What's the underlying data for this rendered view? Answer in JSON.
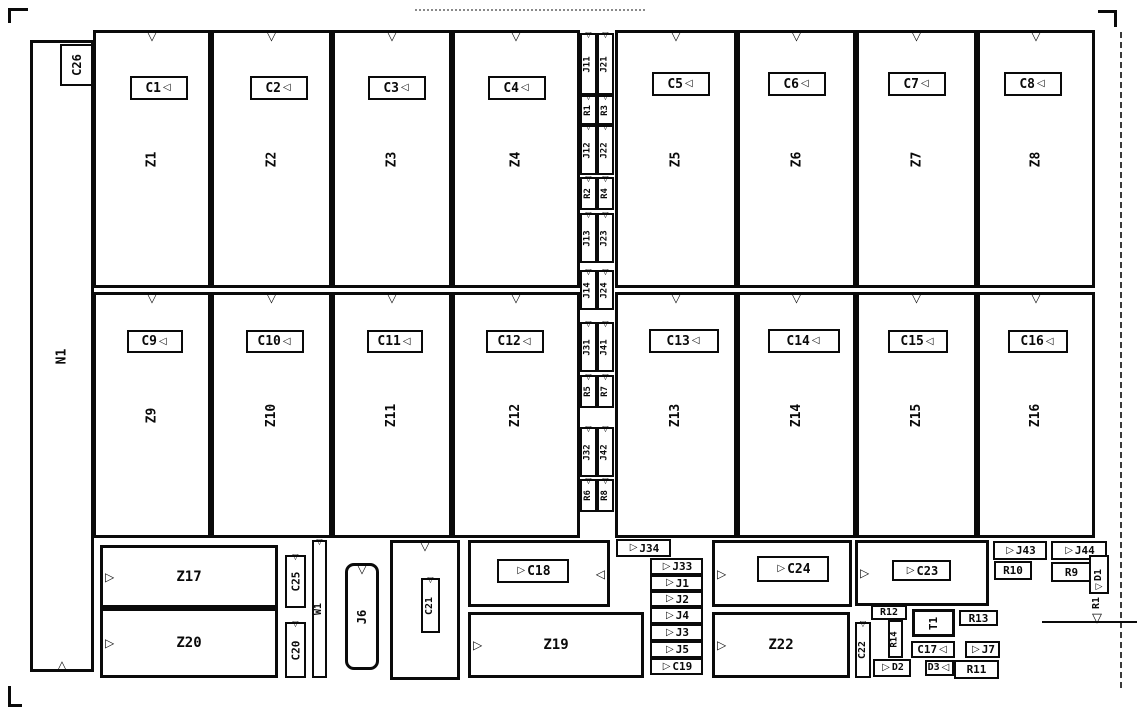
{
  "meta": {
    "width": 1137,
    "height": 720,
    "bg": "#ffffff",
    "ink": "#0a0a0a"
  },
  "icons": {
    "pin1_notch": "▽",
    "pin_up": "△",
    "arrow_right": "▷",
    "arrow_left": "◁"
  },
  "components": [
    {
      "n": "component-n1",
      "t": "N1",
      "x": 30,
      "y": 40,
      "w": 64,
      "h": 632,
      "v": 1,
      "b": 3,
      "tri": [
        "nb"
      ],
      "fs": 13
    },
    {
      "n": "capacitor-c26",
      "t": "C26",
      "x": 60,
      "y": 44,
      "w": 33,
      "h": 42,
      "v": 1,
      "b": 2,
      "tri": [],
      "fs": 12
    },
    {
      "n": "ic-z1",
      "t": "Z1",
      "x": 93,
      "y": 30,
      "w": 118,
      "h": 258,
      "v": 1,
      "b": 3,
      "tri": [
        "nt"
      ],
      "fs": 13
    },
    {
      "n": "ic-z2",
      "t": "Z2",
      "x": 211,
      "y": 30,
      "w": 121,
      "h": 258,
      "v": 1,
      "b": 3,
      "tri": [
        "nt"
      ],
      "fs": 13
    },
    {
      "n": "ic-z3",
      "t": "Z3",
      "x": 332,
      "y": 30,
      "w": 120,
      "h": 258,
      "v": 1,
      "b": 3,
      "tri": [
        "nt"
      ],
      "fs": 13
    },
    {
      "n": "ic-z4",
      "t": "Z4",
      "x": 452,
      "y": 30,
      "w": 128,
      "h": 258,
      "v": 1,
      "b": 3,
      "tri": [
        "nt"
      ],
      "fs": 13
    },
    {
      "n": "ic-z5",
      "t": "Z5",
      "x": 615,
      "y": 30,
      "w": 122,
      "h": 258,
      "v": 1,
      "b": 3,
      "tri": [
        "nt"
      ],
      "fs": 13
    },
    {
      "n": "ic-z6",
      "t": "Z6",
      "x": 737,
      "y": 30,
      "w": 119,
      "h": 258,
      "v": 1,
      "b": 3,
      "tri": [
        "nt"
      ],
      "fs": 13
    },
    {
      "n": "ic-z7",
      "t": "Z7",
      "x": 856,
      "y": 30,
      "w": 121,
      "h": 258,
      "v": 1,
      "b": 3,
      "tri": [
        "nt"
      ],
      "fs": 13
    },
    {
      "n": "ic-z8",
      "t": "Z8",
      "x": 977,
      "y": 30,
      "w": 118,
      "h": 258,
      "v": 1,
      "b": 3,
      "tri": [
        "nt"
      ],
      "fs": 13
    },
    {
      "n": "capacitor-c1",
      "t": "C1",
      "x": 130,
      "y": 76,
      "w": 58,
      "h": 24,
      "v": 0,
      "b": 2,
      "tri": [
        "inR"
      ],
      "fs": 13
    },
    {
      "n": "capacitor-c2",
      "t": "C2",
      "x": 250,
      "y": 76,
      "w": 58,
      "h": 24,
      "v": 0,
      "b": 2,
      "tri": [
        "inR"
      ],
      "fs": 13
    },
    {
      "n": "capacitor-c3",
      "t": "C3",
      "x": 368,
      "y": 76,
      "w": 58,
      "h": 24,
      "v": 0,
      "b": 2,
      "tri": [
        "inR"
      ],
      "fs": 13
    },
    {
      "n": "capacitor-c4",
      "t": "C4",
      "x": 488,
      "y": 76,
      "w": 58,
      "h": 24,
      "v": 0,
      "b": 2,
      "tri": [
        "inR"
      ],
      "fs": 13
    },
    {
      "n": "capacitor-c5",
      "t": "C5",
      "x": 652,
      "y": 72,
      "w": 58,
      "h": 24,
      "v": 0,
      "b": 2,
      "tri": [
        "inR"
      ],
      "fs": 13
    },
    {
      "n": "capacitor-c6",
      "t": "C6",
      "x": 768,
      "y": 72,
      "w": 58,
      "h": 24,
      "v": 0,
      "b": 2,
      "tri": [
        "inR"
      ],
      "fs": 13
    },
    {
      "n": "capacitor-c7",
      "t": "C7",
      "x": 888,
      "y": 72,
      "w": 58,
      "h": 24,
      "v": 0,
      "b": 2,
      "tri": [
        "inR"
      ],
      "fs": 13
    },
    {
      "n": "capacitor-c8",
      "t": "C8",
      "x": 1004,
      "y": 72,
      "w": 58,
      "h": 24,
      "v": 0,
      "b": 2,
      "tri": [
        "inR"
      ],
      "fs": 13
    },
    {
      "n": "ic-z9",
      "t": "Z9",
      "x": 93,
      "y": 292,
      "w": 118,
      "h": 246,
      "v": 1,
      "b": 3,
      "tri": [
        "nt"
      ],
      "fs": 13
    },
    {
      "n": "ic-z10",
      "t": "Z10",
      "x": 211,
      "y": 292,
      "w": 121,
      "h": 246,
      "v": 1,
      "b": 3,
      "tri": [
        "nt"
      ],
      "fs": 13
    },
    {
      "n": "ic-z11",
      "t": "Z11",
      "x": 332,
      "y": 292,
      "w": 120,
      "h": 246,
      "v": 1,
      "b": 3,
      "tri": [
        "nt"
      ],
      "fs": 13
    },
    {
      "n": "ic-z12",
      "t": "Z12",
      "x": 452,
      "y": 292,
      "w": 128,
      "h": 246,
      "v": 1,
      "b": 3,
      "tri": [
        "nt"
      ],
      "fs": 13
    },
    {
      "n": "ic-z13",
      "t": "Z13",
      "x": 615,
      "y": 292,
      "w": 122,
      "h": 246,
      "v": 1,
      "b": 3,
      "tri": [
        "nt"
      ],
      "fs": 13
    },
    {
      "n": "ic-z14",
      "t": "Z14",
      "x": 737,
      "y": 292,
      "w": 119,
      "h": 246,
      "v": 1,
      "b": 3,
      "tri": [
        "nt"
      ],
      "fs": 13
    },
    {
      "n": "ic-z15",
      "t": "Z15",
      "x": 856,
      "y": 292,
      "w": 121,
      "h": 246,
      "v": 1,
      "b": 3,
      "tri": [
        "nt"
      ],
      "fs": 13
    },
    {
      "n": "ic-z16",
      "t": "Z16",
      "x": 977,
      "y": 292,
      "w": 118,
      "h": 246,
      "v": 1,
      "b": 3,
      "tri": [
        "nt"
      ],
      "fs": 13
    },
    {
      "n": "capacitor-c9",
      "t": "C9",
      "x": 127,
      "y": 330,
      "w": 56,
      "h": 23,
      "v": 0,
      "b": 2,
      "tri": [
        "inR"
      ],
      "fs": 13
    },
    {
      "n": "capacitor-c10",
      "t": "C10",
      "x": 246,
      "y": 330,
      "w": 58,
      "h": 23,
      "v": 0,
      "b": 2,
      "tri": [
        "inR"
      ],
      "fs": 13
    },
    {
      "n": "capacitor-c11",
      "t": "C11",
      "x": 367,
      "y": 330,
      "w": 56,
      "h": 23,
      "v": 0,
      "b": 2,
      "tri": [
        "inR"
      ],
      "fs": 13
    },
    {
      "n": "capacitor-c12",
      "t": "C12",
      "x": 486,
      "y": 330,
      "w": 58,
      "h": 23,
      "v": 0,
      "b": 2,
      "tri": [
        "inR"
      ],
      "fs": 13
    },
    {
      "n": "capacitor-c13",
      "t": "C13",
      "x": 649,
      "y": 329,
      "w": 70,
      "h": 24,
      "v": 0,
      "b": 2,
      "tri": [
        "inR"
      ],
      "fs": 13
    },
    {
      "n": "capacitor-c14",
      "t": "C14",
      "x": 768,
      "y": 329,
      "w": 72,
      "h": 24,
      "v": 0,
      "b": 2,
      "tri": [
        "inR"
      ],
      "fs": 13
    },
    {
      "n": "capacitor-c15",
      "t": "C15",
      "x": 888,
      "y": 330,
      "w": 60,
      "h": 23,
      "v": 0,
      "b": 2,
      "tri": [
        "inR"
      ],
      "fs": 13
    },
    {
      "n": "capacitor-c16",
      "t": "C16",
      "x": 1008,
      "y": 330,
      "w": 60,
      "h": 23,
      "v": 0,
      "b": 2,
      "tri": [
        "inR"
      ],
      "fs": 13
    },
    {
      "n": "jumper-j11",
      "t": "J11",
      "x": 580,
      "y": 33,
      "w": 17,
      "h": 62,
      "v": 1,
      "b": 2,
      "tri": [
        "nt"
      ],
      "fs": 9
    },
    {
      "n": "resistor-r1",
      "t": "R1",
      "x": 580,
      "y": 95,
      "w": 17,
      "h": 30,
      "v": 1,
      "b": 2,
      "tri": [
        "nt"
      ],
      "fs": 9
    },
    {
      "n": "jumper-j12",
      "t": "J12",
      "x": 580,
      "y": 125,
      "w": 17,
      "h": 50,
      "v": 1,
      "b": 2,
      "tri": [
        "nt"
      ],
      "fs": 9
    },
    {
      "n": "resistor-r2",
      "t": "R2",
      "x": 580,
      "y": 177,
      "w": 17,
      "h": 33,
      "v": 1,
      "b": 2,
      "tri": [
        "nt"
      ],
      "fs": 9
    },
    {
      "n": "jumper-j13",
      "t": "J13",
      "x": 580,
      "y": 213,
      "w": 17,
      "h": 50,
      "v": 1,
      "b": 2,
      "tri": [
        "nt"
      ],
      "fs": 9
    },
    {
      "n": "jumper-j14",
      "t": "J14",
      "x": 580,
      "y": 270,
      "w": 17,
      "h": 40,
      "v": 1,
      "b": 2,
      "tri": [
        "nt"
      ],
      "fs": 9
    },
    {
      "n": "jumper-j31",
      "t": "J31",
      "x": 580,
      "y": 322,
      "w": 17,
      "h": 50,
      "v": 1,
      "b": 2,
      "tri": [
        "nt"
      ],
      "fs": 9
    },
    {
      "n": "resistor-r5",
      "t": "R5",
      "x": 580,
      "y": 375,
      "w": 17,
      "h": 33,
      "v": 1,
      "b": 2,
      "tri": [
        "nt"
      ],
      "fs": 9
    },
    {
      "n": "jumper-j32",
      "t": "J32",
      "x": 580,
      "y": 427,
      "w": 17,
      "h": 50,
      "v": 1,
      "b": 2,
      "tri": [
        "nt"
      ],
      "fs": 9
    },
    {
      "n": "resistor-r6",
      "t": "R6",
      "x": 580,
      "y": 479,
      "w": 17,
      "h": 33,
      "v": 1,
      "b": 2,
      "tri": [
        "nt"
      ],
      "fs": 9
    },
    {
      "n": "jumper-j21",
      "t": "J21",
      "x": 597,
      "y": 33,
      "w": 17,
      "h": 62,
      "v": 1,
      "b": 2,
      "tri": [
        "nt"
      ],
      "fs": 9
    },
    {
      "n": "resistor-r3",
      "t": "R3",
      "x": 597,
      "y": 95,
      "w": 17,
      "h": 30,
      "v": 1,
      "b": 2,
      "tri": [
        "nt"
      ],
      "fs": 9
    },
    {
      "n": "jumper-j22",
      "t": "J22",
      "x": 597,
      "y": 125,
      "w": 17,
      "h": 50,
      "v": 1,
      "b": 2,
      "tri": [
        "nt"
      ],
      "fs": 9
    },
    {
      "n": "resistor-r4",
      "t": "R4",
      "x": 597,
      "y": 177,
      "w": 17,
      "h": 33,
      "v": 1,
      "b": 2,
      "tri": [
        "nt"
      ],
      "fs": 9
    },
    {
      "n": "jumper-j23",
      "t": "J23",
      "x": 597,
      "y": 213,
      "w": 17,
      "h": 50,
      "v": 1,
      "b": 2,
      "tri": [
        "nt"
      ],
      "fs": 9
    },
    {
      "n": "jumper-j24",
      "t": "J24",
      "x": 597,
      "y": 270,
      "w": 17,
      "h": 40,
      "v": 1,
      "b": 2,
      "tri": [
        "nt"
      ],
      "fs": 9
    },
    {
      "n": "jumper-j41",
      "t": "J41",
      "x": 597,
      "y": 322,
      "w": 17,
      "h": 50,
      "v": 1,
      "b": 2,
      "tri": [
        "nt"
      ],
      "fs": 9
    },
    {
      "n": "resistor-r7",
      "t": "R7",
      "x": 597,
      "y": 375,
      "w": 17,
      "h": 33,
      "v": 1,
      "b": 2,
      "tri": [
        "nt"
      ],
      "fs": 9
    },
    {
      "n": "jumper-j42",
      "t": "J42",
      "x": 597,
      "y": 427,
      "w": 17,
      "h": 50,
      "v": 1,
      "b": 2,
      "tri": [
        "nt"
      ],
      "fs": 9
    },
    {
      "n": "resistor-r8",
      "t": "R8",
      "x": 597,
      "y": 479,
      "w": 17,
      "h": 33,
      "v": 1,
      "b": 2,
      "tri": [
        "nt"
      ],
      "fs": 9
    },
    {
      "n": "ic-z17",
      "t": "Z17",
      "x": 100,
      "y": 545,
      "w": 178,
      "h": 63,
      "v": 0,
      "b": 3,
      "tri": [
        "edgeL"
      ],
      "fs": 14
    },
    {
      "n": "ic-z20",
      "t": "Z20",
      "x": 100,
      "y": 608,
      "w": 178,
      "h": 70,
      "v": 0,
      "b": 3,
      "tri": [
        "edgeL"
      ],
      "fs": 14
    },
    {
      "n": "capacitor-c25",
      "t": "C25",
      "x": 285,
      "y": 555,
      "w": 21,
      "h": 53,
      "v": 1,
      "b": 2,
      "tri": [
        "nt"
      ],
      "fs": 11
    },
    {
      "n": "capacitor-c20",
      "t": "C20",
      "x": 285,
      "y": 622,
      "w": 21,
      "h": 56,
      "v": 1,
      "b": 2,
      "tri": [
        "nt"
      ],
      "fs": 11
    },
    {
      "n": "jumper-w1",
      "t": "W1",
      "x": 312,
      "y": 540,
      "w": 15,
      "h": 138,
      "v": 1,
      "b": 2,
      "tri": [
        "nt"
      ],
      "fs": 10
    },
    {
      "n": "connector-j6",
      "t": "J6",
      "x": 345,
      "y": 563,
      "w": 34,
      "h": 107,
      "v": 1,
      "b": 3,
      "tri": [
        "nt"
      ],
      "fs": 12,
      "r": 1
    },
    {
      "n": "container-c21",
      "t": "",
      "x": 390,
      "y": 540,
      "w": 70,
      "h": 140,
      "v": 0,
      "b": 3,
      "tri": [
        "nt"
      ]
    },
    {
      "n": "capacitor-c21",
      "t": "C21",
      "x": 421,
      "y": 578,
      "w": 19,
      "h": 55,
      "v": 1,
      "b": 2,
      "tri": [
        "nt"
      ],
      "fs": 10
    },
    {
      "n": "container-c18",
      "t": "",
      "x": 468,
      "y": 540,
      "w": 142,
      "h": 67,
      "v": 0,
      "b": 3,
      "tri": [
        "edgeR"
      ]
    },
    {
      "n": "capacitor-c18",
      "t": "C18",
      "x": 497,
      "y": 559,
      "w": 72,
      "h": 24,
      "v": 0,
      "b": 2,
      "tri": [
        "inL"
      ],
      "fs": 13
    },
    {
      "n": "ic-z19",
      "t": "Z19",
      "x": 468,
      "y": 612,
      "w": 176,
      "h": 66,
      "v": 0,
      "b": 3,
      "tri": [
        "edgeL"
      ],
      "fs": 14
    },
    {
      "n": "jumper-j34",
      "t": "J34",
      "x": 616,
      "y": 539,
      "w": 55,
      "h": 18,
      "v": 0,
      "b": 2,
      "tri": [
        "inL"
      ],
      "fs": 11
    },
    {
      "n": "jumper-j33",
      "t": "J33",
      "x": 650,
      "y": 558,
      "w": 53,
      "h": 17,
      "v": 0,
      "b": 2,
      "tri": [
        "inL"
      ],
      "fs": 11
    },
    {
      "n": "jumper-j1",
      "t": "J1",
      "x": 650,
      "y": 575,
      "w": 53,
      "h": 16,
      "v": 0,
      "b": 2,
      "tri": [
        "inL"
      ],
      "fs": 11
    },
    {
      "n": "jumper-j2",
      "t": "J2",
      "x": 650,
      "y": 591,
      "w": 53,
      "h": 16,
      "v": 0,
      "b": 2,
      "tri": [
        "inL"
      ],
      "fs": 11
    },
    {
      "n": "jumper-j4",
      "t": "J4",
      "x": 650,
      "y": 607,
      "w": 53,
      "h": 17,
      "v": 0,
      "b": 2,
      "tri": [
        "inL"
      ],
      "fs": 11
    },
    {
      "n": "jumper-j3",
      "t": "J3",
      "x": 650,
      "y": 624,
      "w": 53,
      "h": 17,
      "v": 0,
      "b": 2,
      "tri": [
        "inL"
      ],
      "fs": 11
    },
    {
      "n": "jumper-j5",
      "t": "J5",
      "x": 650,
      "y": 641,
      "w": 53,
      "h": 17,
      "v": 0,
      "b": 2,
      "tri": [
        "inL"
      ],
      "fs": 11
    },
    {
      "n": "capacitor-c19",
      "t": "C19",
      "x": 650,
      "y": 658,
      "w": 53,
      "h": 17,
      "v": 0,
      "b": 2,
      "tri": [
        "inL"
      ],
      "fs": 11
    },
    {
      "n": "container-c24",
      "t": "",
      "x": 712,
      "y": 540,
      "w": 140,
      "h": 67,
      "v": 0,
      "b": 3,
      "tri": [
        "edgeL"
      ]
    },
    {
      "n": "capacitor-c24",
      "t": "C24",
      "x": 757,
      "y": 556,
      "w": 72,
      "h": 26,
      "v": 0,
      "b": 2,
      "tri": [
        "inL"
      ],
      "fs": 13
    },
    {
      "n": "ic-z22",
      "t": "Z22",
      "x": 712,
      "y": 612,
      "w": 138,
      "h": 66,
      "v": 0,
      "b": 3,
      "tri": [
        "edgeL"
      ],
      "fs": 14
    },
    {
      "n": "container-c23",
      "t": "",
      "x": 855,
      "y": 540,
      "w": 134,
      "h": 66,
      "v": 0,
      "b": 3,
      "tri": [
        "edgeL"
      ]
    },
    {
      "n": "capacitor-c23",
      "t": "C23",
      "x": 892,
      "y": 560,
      "w": 59,
      "h": 21,
      "v": 0,
      "b": 2,
      "tri": [
        "inL"
      ],
      "fs": 12
    },
    {
      "n": "jumper-j43",
      "t": "J43",
      "x": 993,
      "y": 541,
      "w": 54,
      "h": 19,
      "v": 0,
      "b": 2,
      "tri": [
        "inL"
      ],
      "fs": 11
    },
    {
      "n": "jumper-j44",
      "t": "J44",
      "x": 1051,
      "y": 541,
      "w": 56,
      "h": 19,
      "v": 0,
      "b": 2,
      "tri": [
        "inL"
      ],
      "fs": 11
    },
    {
      "n": "resistor-r10",
      "t": "R10",
      "x": 994,
      "y": 561,
      "w": 38,
      "h": 19,
      "v": 0,
      "b": 2,
      "tri": [],
      "fs": 11
    },
    {
      "n": "resistor-r9",
      "t": "R9",
      "x": 1051,
      "y": 562,
      "w": 41,
      "h": 20,
      "v": 0,
      "b": 2,
      "tri": [],
      "fs": 11
    },
    {
      "n": "diode-d1",
      "t": "D1",
      "x": 1089,
      "y": 555,
      "w": 20,
      "h": 39,
      "v": 1,
      "b": 2,
      "tri": [
        "db"
      ],
      "fs": 10
    },
    {
      "n": "resistor-r12",
      "t": "R12",
      "x": 871,
      "y": 605,
      "w": 36,
      "h": 15,
      "v": 0,
      "b": 2,
      "tri": [],
      "fs": 10
    },
    {
      "n": "resistor-r14",
      "t": "R14",
      "x": 888,
      "y": 620,
      "w": 15,
      "h": 38,
      "v": 1,
      "b": 2,
      "tri": [],
      "fs": 9
    },
    {
      "n": "component-t1",
      "t": "T1",
      "x": 912,
      "y": 609,
      "w": 43,
      "h": 28,
      "v": 1,
      "b": 3,
      "tri": [],
      "fs": 11
    },
    {
      "n": "resistor-r13",
      "t": "R13",
      "x": 959,
      "y": 610,
      "w": 39,
      "h": 16,
      "v": 0,
      "b": 2,
      "tri": [],
      "fs": 11
    },
    {
      "n": "capacitor-c22",
      "t": "C22",
      "x": 855,
      "y": 622,
      "w": 16,
      "h": 56,
      "v": 1,
      "b": 2,
      "tri": [
        "nt"
      ],
      "fs": 10
    },
    {
      "n": "capacitor-c17",
      "t": "C17",
      "x": 911,
      "y": 641,
      "w": 44,
      "h": 17,
      "v": 0,
      "b": 2,
      "tri": [
        "inR"
      ],
      "fs": 11
    },
    {
      "n": "jumper-j7",
      "t": "J7",
      "x": 965,
      "y": 641,
      "w": 35,
      "h": 17,
      "v": 0,
      "b": 2,
      "tri": [
        "inL"
      ],
      "fs": 11
    },
    {
      "n": "diode-d2",
      "t": "D2",
      "x": 873,
      "y": 659,
      "w": 38,
      "h": 18,
      "v": 0,
      "b": 2,
      "tri": [
        "inL"
      ],
      "fs": 10
    },
    {
      "n": "diode-d3",
      "t": "D3",
      "x": 925,
      "y": 660,
      "w": 29,
      "h": 16,
      "v": 0,
      "b": 2,
      "tri": [
        "inR"
      ],
      "fs": 10
    },
    {
      "n": "resistor-r11",
      "t": "R11",
      "x": 954,
      "y": 660,
      "w": 45,
      "h": 19,
      "v": 0,
      "b": 2,
      "tri": [],
      "fs": 11
    },
    {
      "n": "component-r1-edge-marker",
      "t": "R1",
      "x": 1090,
      "y": 590,
      "w": 15,
      "h": 26,
      "v": 1,
      "b": 0,
      "tri": [],
      "fs": 10
    },
    {
      "n": "edge-marker",
      "t": "",
      "x": 1088,
      "y": 612,
      "w": 18,
      "h": 14,
      "v": 0,
      "b": 0,
      "tri": [
        "nt"
      ]
    }
  ]
}
